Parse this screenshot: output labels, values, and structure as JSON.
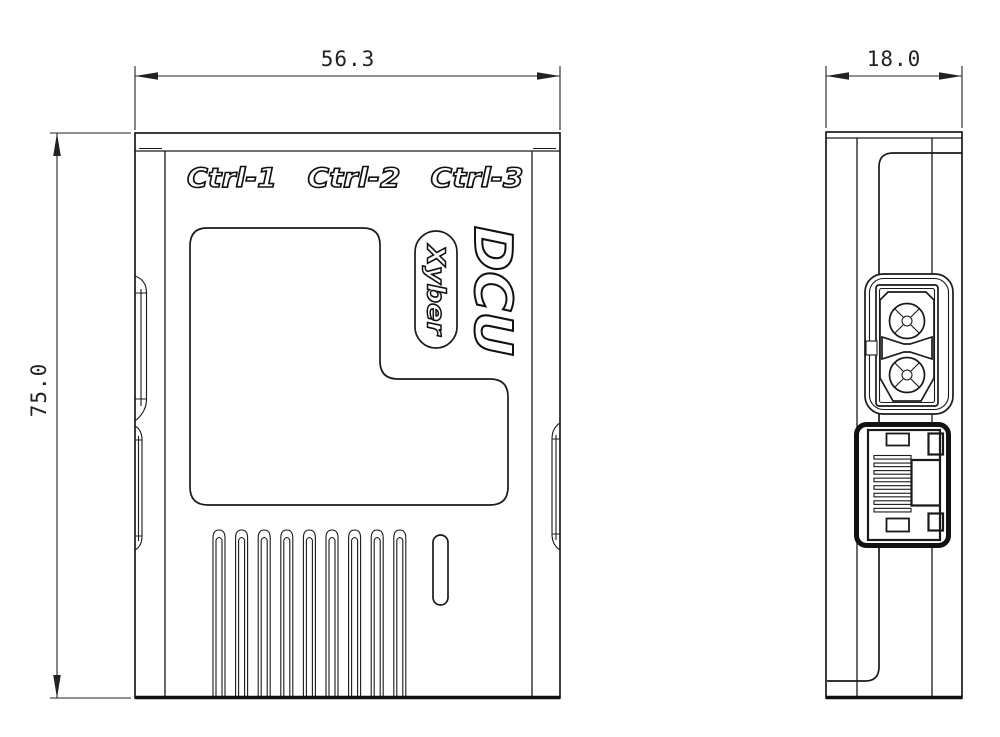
{
  "labels": {
    "ctrl1": "Ctrl-1",
    "ctrl2": "Ctrl-2",
    "ctrl3": "Ctrl-3",
    "product": "DCU",
    "brand": "Xyber"
  },
  "dimensions": {
    "front_width": "56.3",
    "front_height": "75.0",
    "side_width": "18.0"
  },
  "colors": {
    "line": "#1a1a1a",
    "background": "#ffffff"
  }
}
